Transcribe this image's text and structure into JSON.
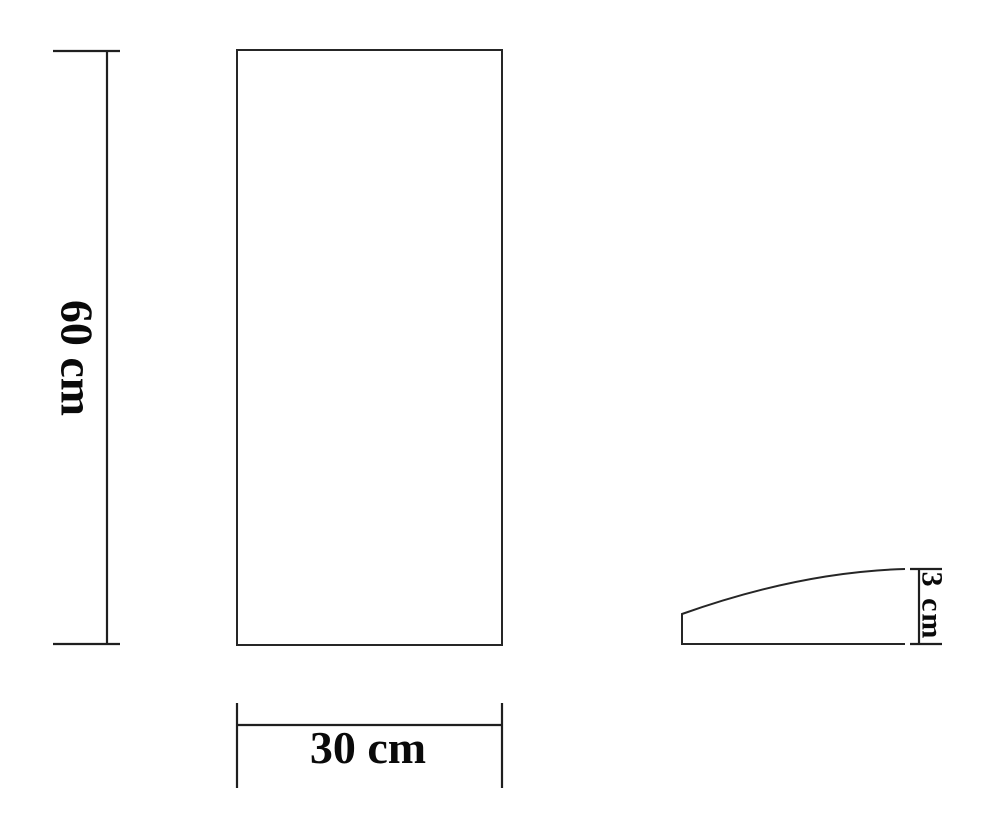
{
  "diagram": {
    "type": "technical-drawing",
    "views": {
      "front": {
        "shape": "rectangle",
        "height": {
          "value": 60,
          "unit": "cm",
          "label": "60 cm"
        },
        "width": {
          "value": 30,
          "unit": "cm",
          "label": "30 cm"
        }
      },
      "side": {
        "shape": "tapered-profile-curved-top",
        "thickness": {
          "value": 3,
          "unit": "cm",
          "label": "3 cm"
        }
      }
    },
    "colors": {
      "line": "#262626",
      "dimension_line": "#1f1f1f",
      "text": "#0a0a0a",
      "background": "#ffffff"
    }
  }
}
